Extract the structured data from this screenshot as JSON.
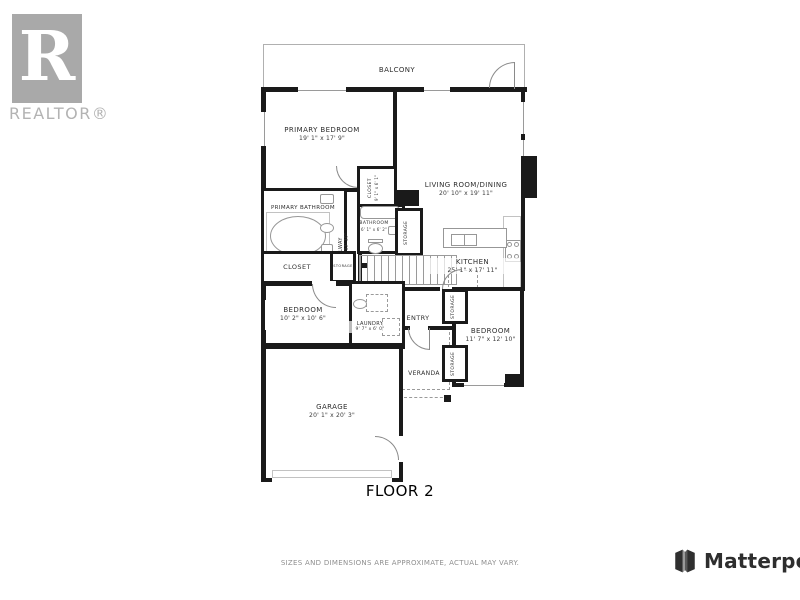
{
  "branding": {
    "realtor_logo_text": "REALTOR®",
    "realtor_letter": "R",
    "matterport_name": "Matterport"
  },
  "footer": {
    "disclaimer": "SIZES AND DIMENSIONS ARE APPROXIMATE, ACTUAL MAY VARY.",
    "floor_label": "FLOOR 2"
  },
  "rooms": {
    "balcony": {
      "name": "BALCONY"
    },
    "primary_bedroom": {
      "name": "PRIMARY BEDROOM",
      "dims": "19' 1\" x 17' 9\""
    },
    "living_dining": {
      "name": "LIVING ROOM/DINING",
      "dims": "20' 10\" x 19' 11\""
    },
    "primary_bathroom": {
      "name": "PRIMARY BATHROOM",
      "dims": "10' 2\" x 10' 5\""
    },
    "closet_upper": {
      "name": "CLOSET",
      "dims": "9' 1\" x 6' 1\""
    },
    "bathroom": {
      "name": "BATHROOM",
      "dims": "6' 1\" x 6' 2\""
    },
    "hallway": {
      "name": "HALLWAY",
      "dims": "3' 2\" x 13' 10\""
    },
    "closet_primary": {
      "name": "CLOSET"
    },
    "storage_tiny": {
      "name": "STORAGE"
    },
    "storage_mid": {
      "name": "STORAGE"
    },
    "kitchen": {
      "name": "KITCHEN",
      "dims": "25' 1\" x 17' 11\""
    },
    "bedroom_left": {
      "name": "BEDROOM",
      "dims": "10' 2\" x 10' 6\""
    },
    "laundry": {
      "name": "LAUNDRY",
      "dims": "9' 7\" x 6' 0\""
    },
    "entry": {
      "name": "ENTRY"
    },
    "veranda": {
      "name": "VERANDA"
    },
    "bedroom_right": {
      "name": "BEDROOM",
      "dims": "11' 7\" x 12' 10\""
    },
    "storage_right_top": {
      "name": "STORAGE"
    },
    "storage_right_bottom": {
      "name": "STORAGE"
    },
    "garage": {
      "name": "GARAGE",
      "dims": "20' 1\" x 20' 3\""
    }
  },
  "colors": {
    "wall": "#1a1a1a",
    "fixture_line": "#979797",
    "realtor_gray": "#a9a9a9",
    "matterport_dark": "#2f2f2f",
    "disclaimer_gray": "#8f8f8f"
  }
}
